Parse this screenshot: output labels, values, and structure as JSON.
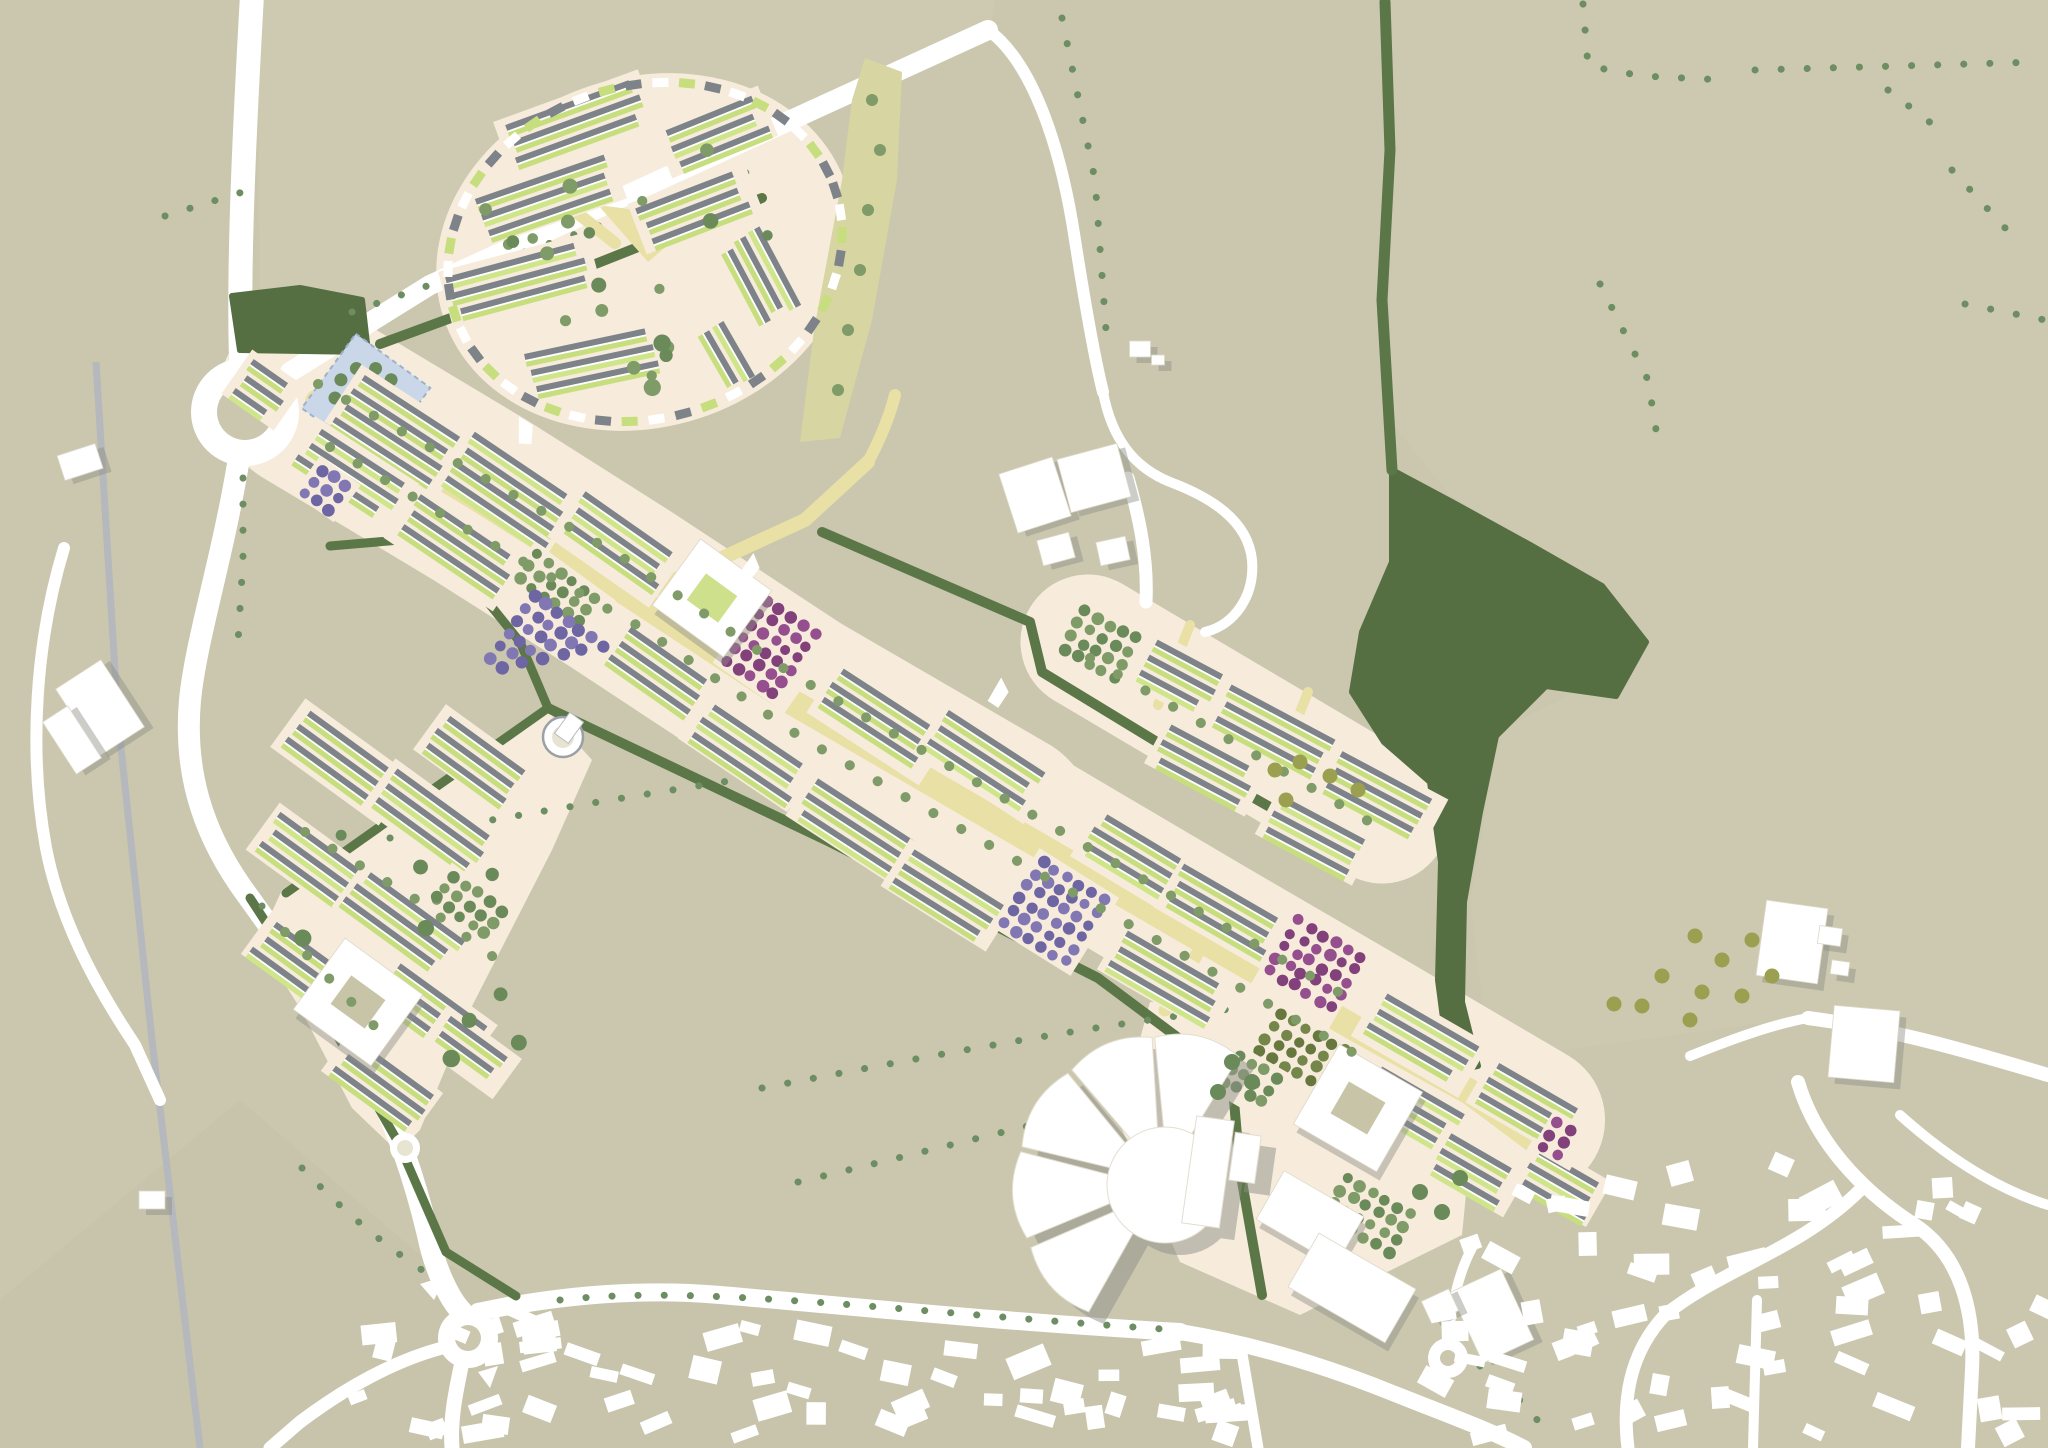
{
  "meta": {
    "title": "Urban extension masterplan aerial site plan",
    "width": 2048,
    "height": 1448
  },
  "palette": {
    "bg": "#cac7ae",
    "tint_north": "#cfccb4",
    "tint_east": "#cecbb3",
    "tint_south": "#c5c2a9",
    "road": "#ffffff",
    "rail": "#b5b8bd",
    "cream": "#f7ecdc",
    "boulevard": "#e9e0a6",
    "hedge": "#5b7647",
    "woodland": "#566f42",
    "field_tree": "#6d8d63",
    "street_tree": "#7f9b68",
    "street_tree_dark": "#6a8a5a",
    "garden": "#c6de7d",
    "garden_bright": "#cfe58a",
    "roof": "#7e838a",
    "white": "#ffffff",
    "shadow": "#8f8f88",
    "purple": "#8177b2",
    "purple_dark": "#6e65a3",
    "magenta": "#964f8e",
    "magenta_dark": "#83417c",
    "olive": "#75864b",
    "olive_dark": "#67783f",
    "olive_tree": "#9aa04f",
    "blue_park": "#c9d7e8",
    "blue_park_edge": "#9fb0cc",
    "blue_park_inner": "#dfe7f2",
    "green_strip": "#d7d5a1",
    "court_green": "#cfe08d",
    "court_beige": "#c8c4a8"
  },
  "tints": [
    {
      "points": "260,350 430,285 990,28 995,0 258,0",
      "fill": "#cfccb4",
      "opacity": 0.55
    },
    {
      "points": "1390,0 2048,0 2048,1070 1820,1015 1490,1060 1470,900 1500,730 1640,660 1600,592 1450,495 1390,420 1390,150",
      "fill": "#cecbb3",
      "opacity": 0.45
    },
    {
      "points": "240,1100 420,1255 530,1295 760,1288 1000,1322 1200,1335 1300,1360 1430,1400 1500,1448 0,1448 0,1300",
      "fill": "#c5c2a9",
      "opacity": 0.6
    }
  ],
  "rail": {
    "d": "M 96,362 L 118,720 L 152,1040 L 186,1330 L 200,1448",
    "width": 7
  },
  "cream_bands": [
    {
      "d": "M 310,398 L 480,500 L 622,590 L 792,702 L 1002,824",
      "w": 185
    },
    {
      "d": "M 1010,815 L 1205,930 L 1370,1026 L 1530,1120",
      "w": 150
    },
    {
      "d": "M 1088,642 L 1382,816",
      "w": 135
    }
  ],
  "cream_polys": [
    {
      "points": "282,890 545,708 592,760 552,850 470,1010 420,1130 398,1152 352,1108 300,1008 258,942"
    },
    {
      "points": "1150,1002 1340,1002 1475,1102 1462,1235 1300,1315 1180,1262 1118,1120"
    }
  ],
  "circle_area": {
    "cx": 645,
    "cy": 252,
    "rx": 212,
    "ry": 175,
    "rot": -18
  },
  "roads": [
    {
      "d": "M 252,-5 C 245,120 238,260 241,358",
      "w": 24
    },
    {
      "d": "M 290,372 L 430,285 L 988,30",
      "w": 20
    },
    {
      "d": "M 988,30 C 1030,60 1060,140 1075,240 C 1086,310 1095,360 1103,392",
      "w": 12
    },
    {
      "d": "M 1103,392 C 1112,440 1135,468 1170,482 C 1210,497 1248,520 1252,560 C 1255,595 1235,625 1205,632",
      "w": 10
    },
    {
      "d": "M 1128,478 C 1140,520 1148,560 1146,602",
      "w": 13
    },
    {
      "d": "M 238,464 C 222,560 196,640 190,700 C 184,768 200,828 242,888 C 278,938 330,1010 370,1075 C 395,1120 415,1180 428,1235 C 435,1270 450,1300 462,1312",
      "w": 22
    },
    {
      "d": "M 478,1312 C 560,1295 640,1288 720,1295 C 850,1306 1000,1322 1180,1332",
      "w": 18
    },
    {
      "d": "M 462,1362 C 455,1395 450,1420 452,1448",
      "w": 15
    },
    {
      "d": "M 442,1348 C 390,1362 340,1392 300,1422 L 270,1448",
      "w": 13
    },
    {
      "d": "M 1180,1332 C 1260,1345 1330,1368 1390,1392 C 1450,1416 1490,1430 1524,1448",
      "w": 16
    },
    {
      "d": "M 1240,1342 L 1258,1448",
      "w": 11
    },
    {
      "d": "M 1448,1340 C 1452,1300 1460,1270 1472,1248",
      "w": 10
    },
    {
      "d": "M 1690,1056 C 1730,1040 1770,1025 1808,1018",
      "w": 10
    },
    {
      "d": "M 1808,1018 C 1900,1030 1980,1055 2048,1075",
      "w": 14
    },
    {
      "d": "M 1900,1115 C 1950,1160 2000,1190 2048,1205",
      "w": 10
    },
    {
      "d": "M 1798,1082 C 1815,1140 1860,1190 1915,1225 C 1960,1255 1975,1310 1972,1370 L 1968,1448",
      "w": 14
    },
    {
      "d": "M 1860,1190 C 1800,1250 1720,1270 1665,1315 C 1630,1352 1622,1400 1628,1448",
      "w": 13
    },
    {
      "d": "M 1757,1300 L 1753,1448",
      "w": 10
    },
    {
      "d": "M 64,548 C 36,640 28,750 46,848 C 60,920 95,985 135,1045 L 160,1100",
      "w": 12
    }
  ],
  "roundabouts": [
    {
      "cx": 245,
      "cy": 412,
      "r": 54,
      "ir": 28
    },
    {
      "cx": 468,
      "cy": 1338,
      "r": 30,
      "ir": 13
    },
    {
      "cx": 1448,
      "cy": 1358,
      "r": 20,
      "ir": 8
    }
  ],
  "islands": [
    "420,1284 446,1276 434,1300",
    "492,1300 512,1296 502,1316",
    "478,1372 498,1366 490,1388"
  ],
  "hedges": [
    {
      "d": "M 380,344 L 560,278 L 762,198",
      "w": 10
    },
    {
      "d": "M 330,546 L 424,538 L 460,568",
      "w": 9
    },
    {
      "d": "M 462,570 L 520,642 L 548,708",
      "w": 9
    },
    {
      "d": "M 548,708 L 830,842 L 1098,978 L 1232,1078 L 1240,1170 L 1262,1295",
      "w": 10
    },
    {
      "d": "M 548,708 L 286,893",
      "w": 9
    },
    {
      "d": "M 250,898 L 318,1002 L 398,1142 L 446,1252 L 516,1296",
      "w": 9
    },
    {
      "d": "M 822,532 L 1030,622 L 1042,672 L 1180,756 L 1328,840",
      "w": 10
    },
    {
      "d": "M 1385,2 L 1390,150 L 1382,300 L 1392,470",
      "w": 11
    }
  ],
  "woodlands": [
    "232,296 300,288 362,300 368,352 240,350",
    "1392,470 1452,502 1532,546 1602,586 1646,642 1616,696 1546,686 1496,736 1480,812 1464,902 1462,1002 1478,1066 1450,1072 1438,980 1441,862 1430,782 1384,742 1352,692 1362,632 1392,562"
  ],
  "tree_lines": [
    "M 352,312 L 545,245 L 748,172",
    "M 165,216 L 262,186",
    "M 1583,4 L 1588,66 L 1642,76 L 1725,80",
    "M 1755,70 L 2040,62",
    "M 1888,90 L 1945,134",
    "M 1952,170 L 2018,242",
    "M 1600,284 L 1648,380 L 1658,442",
    "M 1965,304 L 2045,320",
    "M 390,838 C 500,818 620,798 748,778",
    "M 762,1088 C 900,1062 1060,1030 1238,1008",
    "M 798,1182 C 900,1158 1000,1132 1088,1112",
    "M 560,1300 C 700,1284 900,1312 1178,1330",
    "M 302,1168 C 340,1208 380,1242 422,1270",
    "M 243,478 L 243,560 L 238,642",
    "M 262,906 L 292,962 L 322,1012",
    "M 1062,18 L 1095,180 L 1106,330",
    "M 1480,1366 L 1516,1396 L 1548,1432"
  ],
  "green_strip": {
    "points": "865,58 902,72 897,180 872,320 840,438 800,442 814,330 842,180 852,100"
  },
  "strip_trees": [
    [
      872,
      100
    ],
    [
      880,
      150
    ],
    [
      868,
      210
    ],
    [
      860,
      270
    ],
    [
      848,
      330
    ],
    [
      838,
      390
    ]
  ],
  "blue_park": {
    "cx": 366,
    "cy": 398,
    "size": 92,
    "angle": 36
  },
  "boulevard": {
    "d": "M 318,402 L 480,500 L 622,590 L 792,702 L 1002,824 L 1195,936 L 1358,1030 L 1470,1092 L 1545,1148",
    "w": 26
  },
  "yellow_streets": [
    {
      "d": "M 648,592 L 805,520 L 868,462",
      "w": 14
    },
    {
      "d": "M 868,462 C 880,440 890,415 895,395",
      "w": 12
    },
    {
      "d": "M 1085,645 L 1385,818",
      "w": 13
    },
    {
      "d": "M 1190,625 L 1158,705",
      "w": 10
    },
    {
      "d": "M 1308,692 L 1276,772",
      "w": 10
    },
    {
      "d": "M 538,182 L 615,243",
      "w": 12
    },
    {
      "d": "M 1205,940 L 1165,1010",
      "w": 13
    }
  ],
  "plaza_triangle": "598,205 700,218 648,262",
  "blocks": [
    [
      400,
      430,
      130,
      62,
      33
    ],
    [
      510,
      488,
      130,
      62,
      34
    ],
    [
      617,
      545,
      118,
      60,
      35
    ],
    [
      880,
      722,
      128,
      58,
      33
    ],
    [
      985,
      762,
      126,
      56,
      33
    ],
    [
      1140,
      862,
      120,
      56,
      31
    ],
    [
      1222,
      912,
      118,
      54,
      30
    ],
    [
      1420,
      1040,
      118,
      56,
      30
    ],
    [
      1528,
      1105,
      105,
      52,
      30
    ],
    [
      1560,
      1182,
      84,
      46,
      30
    ],
    [
      350,
      477,
      118,
      58,
      33
    ],
    [
      456,
      548,
      126,
      58,
      34
    ],
    [
      655,
      670,
      105,
      52,
      35
    ],
    [
      748,
      752,
      126,
      50,
      34
    ],
    [
      856,
      828,
      126,
      50,
      33
    ],
    [
      948,
      895,
      118,
      50,
      32
    ],
    [
      1168,
      978,
      126,
      50,
      30
    ],
    [
      1412,
      1108,
      108,
      50,
      30
    ],
    [
      263,
      390,
      58,
      48,
      35
    ],
    [
      1475,
      1170,
      90,
      48,
      30
    ],
    [
      1162,
      668,
      128,
      54,
      28
    ],
    [
      1272,
      732,
      128,
      54,
      28
    ],
    [
      1380,
      796,
      118,
      52,
      28
    ],
    [
      1207,
      766,
      108,
      48,
      28
    ],
    [
      1316,
      836,
      104,
      48,
      28
    ],
    [
      342,
      762,
      128,
      54,
      36
    ],
    [
      432,
      822,
      128,
      54,
      36
    ],
    [
      312,
      862,
      116,
      52,
      36
    ],
    [
      402,
      922,
      126,
      52,
      36
    ],
    [
      298,
      962,
      96,
      48,
      36
    ],
    [
      432,
      1012,
      116,
      50,
      36
    ],
    [
      382,
      1082,
      106,
      48,
      36
    ],
    [
      478,
      762,
      114,
      50,
      36
    ],
    [
      470,
      1052,
      86,
      44,
      36
    ],
    [
      575,
      122,
      148,
      50,
      -20
    ],
    [
      715,
      132,
      108,
      48,
      -22
    ],
    [
      545,
      197,
      148,
      50,
      -19
    ],
    [
      695,
      207,
      118,
      48,
      -21
    ],
    [
      520,
      280,
      148,
      52,
      -15
    ],
    [
      762,
      278,
      98,
      52,
      62
    ],
    [
      592,
      360,
      136,
      48,
      -12
    ],
    [
      724,
      358,
      78,
      44,
      60
    ]
  ],
  "orchards": [
    [
      560,
      592,
      94,
      46,
      36,
      "sage"
    ],
    [
      550,
      655,
      112,
      95,
      36,
      "purple-tri"
    ],
    [
      327,
      489,
      44,
      40,
      36,
      "purple"
    ],
    [
      775,
      650,
      82,
      86,
      35,
      "magenta"
    ],
    [
      1055,
      912,
      88,
      86,
      32,
      "purple"
    ],
    [
      1312,
      968,
      84,
      82,
      30,
      "magenta"
    ],
    [
      1562,
      1140,
      38,
      40,
      30,
      "magenta"
    ],
    [
      1305,
      1052,
      94,
      56,
      30,
      "olive"
    ],
    [
      1105,
      645,
      82,
      54,
      28,
      "sage"
    ],
    [
      1372,
      1215,
      92,
      54,
      30,
      "sage"
    ],
    [
      468,
      905,
      70,
      44,
      36,
      "sage"
    ],
    [
      1250,
      1082,
      60,
      48,
      30,
      "sage"
    ]
  ],
  "white_buildings": [
    [
      712,
      598,
      88,
      82,
      36,
      1
    ],
    [
      1358,
      1108,
      96,
      92,
      30,
      2
    ],
    [
      1310,
      1218,
      92,
      56,
      30,
      0
    ],
    [
      1352,
      1288,
      112,
      62,
      30,
      0
    ],
    [
      358,
      1002,
      96,
      88,
      36,
      2
    ],
    [
      1492,
      1316,
      56,
      78,
      -25,
      0
    ],
    [
      1440,
      1306,
      30,
      24,
      -25,
      0
    ],
    [
      1035,
      495,
      56,
      62,
      -18,
      0
    ],
    [
      1094,
      478,
      62,
      55,
      -15,
      0
    ],
    [
      1056,
      549,
      33,
      26,
      -15,
      0
    ],
    [
      1113,
      551,
      30,
      24,
      -12,
      0
    ],
    [
      1792,
      942,
      62,
      76,
      8,
      0
    ],
    [
      1864,
      1044,
      66,
      72,
      5,
      0
    ],
    [
      1830,
      936,
      23,
      18,
      8,
      0
    ],
    [
      1840,
      968,
      18,
      14,
      8,
      0
    ],
    [
      80,
      462,
      40,
      26,
      -18,
      0
    ],
    [
      100,
      708,
      54,
      80,
      -33,
      0
    ],
    [
      72,
      740,
      30,
      62,
      -33,
      0
    ],
    [
      152,
      1200,
      26,
      18,
      0,
      0
    ],
    [
      1140,
      349,
      21,
      16,
      0,
      0
    ],
    [
      1158,
      360,
      13,
      10,
      0,
      0
    ]
  ],
  "flower": {
    "cx": 1165,
    "cy": 1185,
    "r": 58,
    "petal_angles": [
      138,
      176,
      212,
      248,
      283
    ],
    "r0": 42,
    "r1": 148,
    "hw0": 13,
    "hw1": 17,
    "bars": [
      [
        1208,
        1172,
        38,
        108,
        8
      ],
      [
        1245,
        1158,
        26,
        48,
        8
      ]
    ]
  },
  "tower": {
    "cx": 563,
    "cy": 737
  },
  "small_circle": {
    "cx": 405,
    "cy": 1148
  },
  "ring": {
    "cx": 645,
    "cy": 252,
    "a": 200,
    "b": 166,
    "rot": -18,
    "n": 46
  },
  "street_tree_paths": [
    "M 330,447 L 490,543 L 642,628 L 802,738 L 1012,858 L 1192,960 L 1352,1052",
    "M 318,384 L 470,470 L 622,557 L 792,674 L 1002,797 L 1182,902 L 1347,997",
    "M 1090,658 L 1380,828",
    "M 305,832 L 420,902 L 500,962",
    "M 285,932 L 380,1032"
  ],
  "plaza_trees": [
    [
      1232,
      1062
    ],
    [
      1252,
      1082
    ],
    [
      1218,
      1092
    ],
    [
      1420,
      1192
    ],
    [
      1442,
      1212
    ],
    [
      1460,
      1178
    ]
  ],
  "olive_trees": [
    [
      1275,
      770
    ],
    [
      1300,
      762
    ],
    [
      1330,
      776
    ],
    [
      1358,
      790
    ],
    [
      1286,
      800
    ],
    [
      1695,
      936
    ],
    [
      1722,
      960
    ],
    [
      1752,
      940
    ],
    [
      1702,
      992
    ],
    [
      1662,
      976
    ],
    [
      1742,
      996
    ],
    [
      1772,
      976
    ],
    [
      1642,
      1006
    ],
    [
      1614,
      1004
    ],
    [
      1690,
      1020
    ]
  ],
  "village_clusters": [
    {
      "x0": 330,
      "x1": 1235,
      "ytop0": 1300,
      "ytop1": 1338,
      "depth": 118,
      "n": 58,
      "a0": -25,
      "a1": 25
    },
    {
      "x0": 1400,
      "x1": 2040,
      "ytop0": 1180,
      "ytop1": 1120,
      "depth": 300,
      "n": 62,
      "a0": -30,
      "a1": 30
    }
  ],
  "kites": [
    [
      523,
      432,
      -15
    ],
    [
      748,
      568,
      20
    ],
    [
      997,
      693,
      15
    ]
  ],
  "circle_tree_count": 22,
  "triangle_tree_box": [
    300,
    780,
    220,
    300
  ],
  "seed": 42
}
